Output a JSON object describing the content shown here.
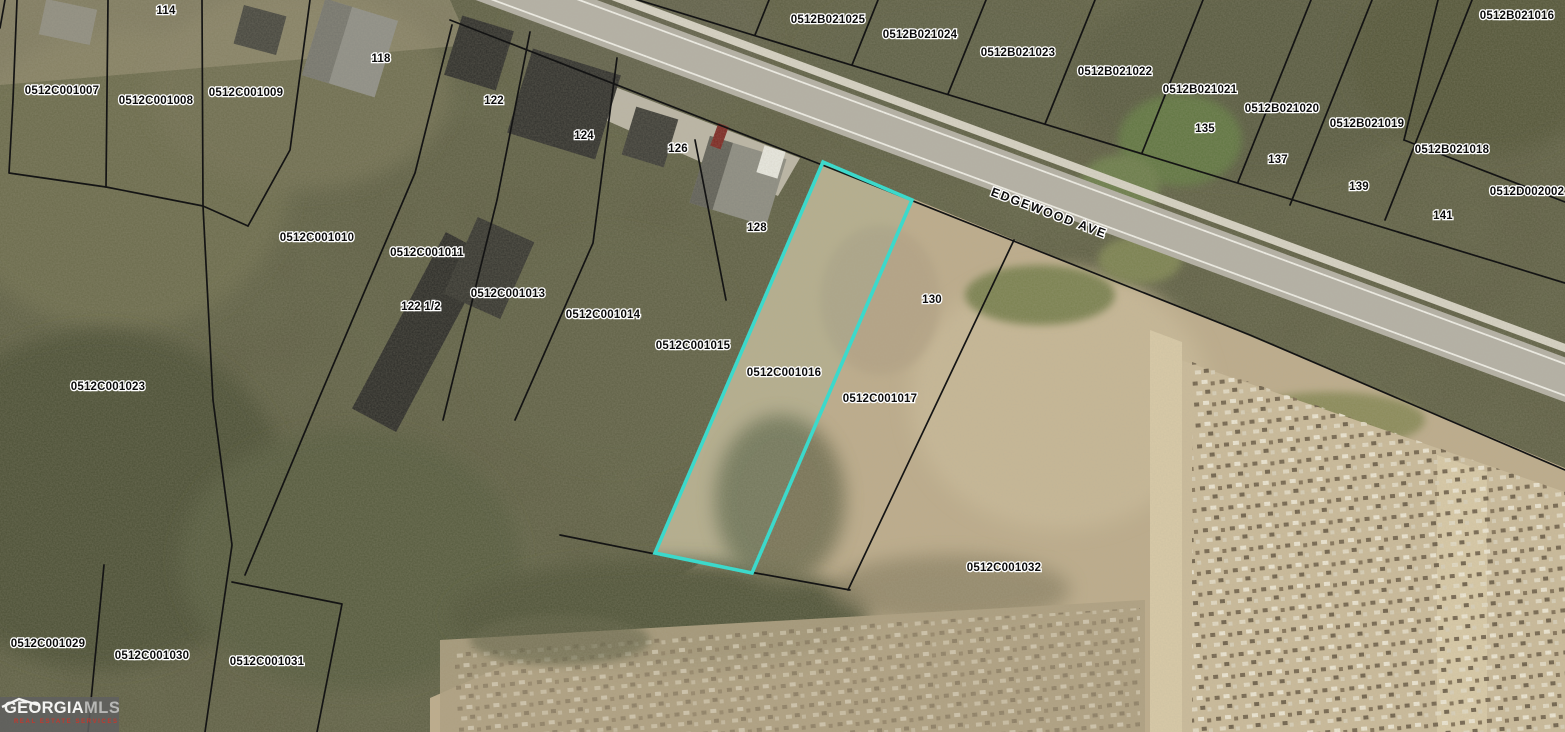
{
  "map": {
    "street_label": "EDGEWOOD AVE",
    "highlight_color": "#3CD9CB",
    "boundary_color": "#141414",
    "selected_parcel": "0512C001016"
  },
  "parcels": {
    "b21025": "0512B021025",
    "b21024": "0512B021024",
    "b21023": "0512B021023",
    "b21022": "0512B021022",
    "b21021": "0512B021021",
    "b21020": "0512B021020",
    "b21019": "0512B021019",
    "b21018": "0512B021018",
    "b21016": "0512B021016",
    "d2002": "0512D002002",
    "c1007": "0512C001007",
    "c1008": "0512C001008",
    "c1009": "0512C001009",
    "c1010": "0512C001010",
    "c1011": "0512C001011",
    "c1013": "0512C001013",
    "c1014": "0512C001014",
    "c1015": "0512C001015",
    "c1016": "0512C001016",
    "c1017": "0512C001017",
    "c1023": "0512C001023",
    "c1029": "0512C001029",
    "c1030": "0512C001030",
    "c1031": "0512C001031",
    "c1032": "0512C001032"
  },
  "addresses": {
    "a114": "114",
    "a118": "118",
    "a122": "122",
    "a1225": "122 1/2",
    "a124": "124",
    "a126": "126",
    "a128": "128",
    "a130": "130",
    "a135": "135",
    "a137": "137",
    "a139": "139",
    "a141": "141"
  },
  "logo": {
    "brand_primary": "GEORGIA",
    "brand_secondary": "MLS",
    "tagline": "REAL ESTATE SERVICES"
  }
}
